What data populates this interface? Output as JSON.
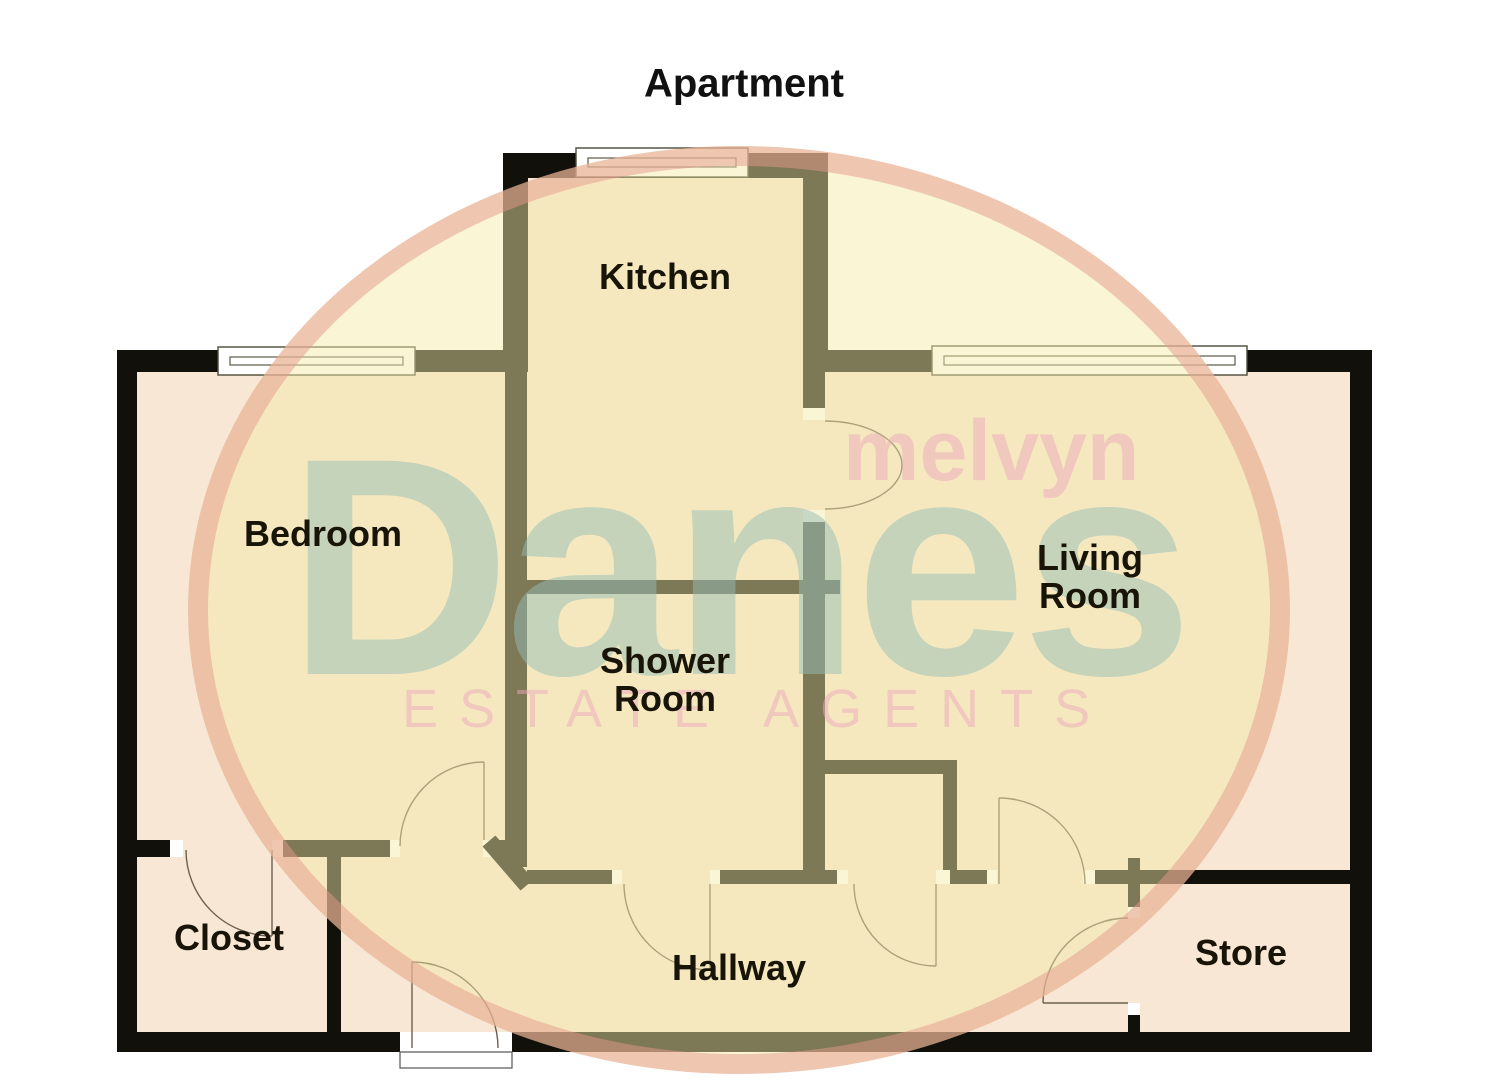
{
  "title": {
    "text": "Apartment",
    "cx": 744,
    "cy": 84
  },
  "rooms": {
    "kitchen": {
      "label": "Kitchen",
      "cx": 665,
      "cy": 277
    },
    "bedroom": {
      "label": "Bedroom",
      "cx": 323,
      "cy": 534
    },
    "living": {
      "label": "Living Room",
      "cx": 1090,
      "cy": 577
    },
    "shower": {
      "label": "Shower Room",
      "cx": 665,
      "cy": 680
    },
    "closet": {
      "label": "Closet",
      "cx": 229,
      "cy": 938
    },
    "hallway": {
      "label": "Hallway",
      "cx": 739,
      "cy": 968
    },
    "store": {
      "label": "Store",
      "cx": 1241,
      "cy": 953
    }
  },
  "watermark": {
    "line1": "melvyn",
    "line2": "Danes",
    "line3": "ESTATE AGENTS",
    "pink_text_color": "rgba(238,168,188,0.5)",
    "green_text_color": "rgba(150,190,183,0.5)",
    "ring_color": "rgba(229,154,142,0.5)",
    "ellipse_fill": "rgba(243,235,168,0.48)"
  },
  "colors": {
    "wall": "#12100a",
    "room_fill": "#f8e7d5",
    "jamb": "#ffffff",
    "window_fill": "#ffffff",
    "window_stroke": "#4a4a3a",
    "arc_stroke": "#6b6050",
    "label_text": "#181407"
  },
  "plan": {
    "width": 1485,
    "height": 1080,
    "fills": [
      [
        528,
        178,
        275,
        402
      ],
      [
        137,
        372,
        1213,
        660
      ]
    ],
    "walls": [
      [
        117,
        350,
        411,
        22
      ],
      [
        803,
        350,
        569,
        22
      ],
      [
        117,
        350,
        20,
        702
      ],
      [
        1350,
        350,
        22,
        702
      ],
      [
        117,
        1032,
        283,
        20
      ],
      [
        512,
        1032,
        860,
        20
      ],
      [
        503,
        153,
        325,
        25
      ],
      [
        503,
        153,
        25,
        219
      ],
      [
        803,
        153,
        25,
        219
      ],
      [
        505,
        372,
        22,
        495
      ],
      [
        803,
        372,
        22,
        36
      ],
      [
        803,
        522,
        22,
        362
      ],
      [
        527,
        580,
        313,
        14
      ],
      [
        137,
        840,
        33,
        17
      ],
      [
        283,
        840,
        107,
        17
      ],
      [
        494,
        840,
        11,
        17
      ],
      [
        327,
        840,
        14,
        192
      ],
      [
        527,
        870,
        85,
        14
      ],
      [
        720,
        870,
        117,
        14
      ],
      [
        950,
        870,
        37,
        14
      ],
      [
        1095,
        870,
        255,
        14
      ],
      [
        810,
        760,
        147,
        14
      ],
      [
        943,
        774,
        14,
        96
      ],
      [
        1128,
        858,
        12,
        12
      ],
      [
        1128,
        884,
        12,
        23
      ],
      [
        1128,
        1015,
        12,
        17
      ]
    ],
    "jambs": [
      [
        170,
        840,
        13,
        17
      ],
      [
        272,
        840,
        11,
        17
      ],
      [
        390,
        840,
        10,
        17
      ],
      [
        483,
        840,
        11,
        17
      ],
      [
        803,
        408,
        22,
        12
      ],
      [
        803,
        510,
        22,
        12
      ],
      [
        612,
        870,
        10,
        14
      ],
      [
        710,
        870,
        10,
        14
      ],
      [
        837,
        870,
        11,
        14
      ],
      [
        936,
        870,
        14,
        14
      ],
      [
        987,
        870,
        10,
        14
      ],
      [
        1083,
        870,
        12,
        14
      ],
      [
        1128,
        907,
        12,
        11
      ],
      [
        1128,
        1003,
        12,
        12
      ],
      [
        400,
        1032,
        12,
        20
      ],
      [
        498,
        1032,
        14,
        20
      ]
    ],
    "windows": [
      [
        218,
        347,
        197,
        28
      ],
      [
        576,
        148,
        172,
        29
      ],
      [
        932,
        346,
        315,
        29
      ]
    ],
    "door_arcs": [
      "M825,421 A77,44 0 0 1 825,509",
      "M484,762 A84,84 0 0 0 400,846",
      "M272,936 A86,86 0 0 1 186,850",
      "M710,970 A86,86 0 0 1 624,884",
      "M936,966 A82,82 0 0 1 854,884",
      "M999,798 A86,86 0 0 1 1085,884",
      "M1043,1003 A85,85 0 0 1 1128,918",
      "M412,962 A86,86 0 0 1 498,1048"
    ],
    "door_leaves": [
      [
        484,
        840,
        484,
        762
      ],
      [
        272,
        850,
        272,
        936
      ],
      [
        710,
        884,
        710,
        970
      ],
      [
        936,
        884,
        936,
        966
      ],
      [
        999,
        884,
        999,
        798
      ],
      [
        1128,
        1003,
        1043,
        1003
      ],
      [
        412,
        1048,
        412,
        962
      ]
    ],
    "diagonal_leaf": [
      489,
      841,
      527,
      885
    ],
    "threshold": [
      400,
      1052,
      112,
      16
    ]
  }
}
